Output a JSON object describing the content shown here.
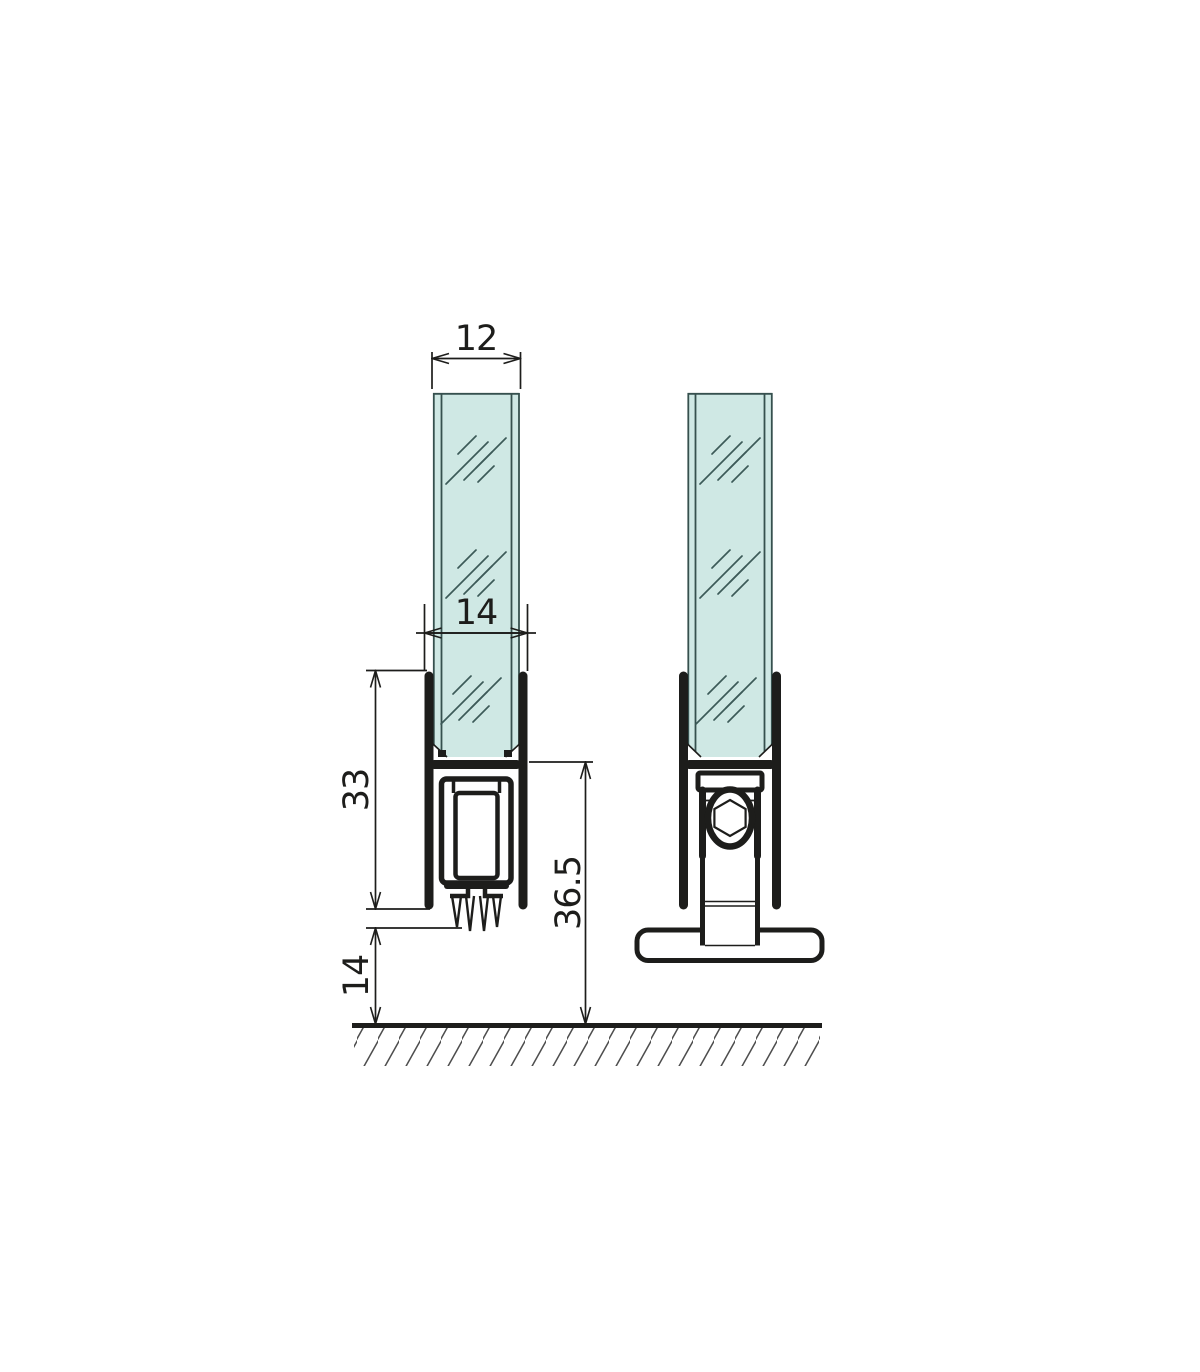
{
  "drawing": {
    "type": "technical-cross-section",
    "subject": "glass door bottom seal and floor clamp fitting",
    "colors": {
      "line": "#1d1d1b",
      "glass_fill": "#cfe8e4",
      "glass_edge": "#36504e",
      "hatch": "#4d4d4d",
      "background": "#ffffff"
    },
    "dimensions": {
      "glass_thickness": "12",
      "channel_width": "14",
      "seal_profile_height": "33",
      "fitting_overall_height": "36.5",
      "floor_clearance": "14"
    }
  }
}
